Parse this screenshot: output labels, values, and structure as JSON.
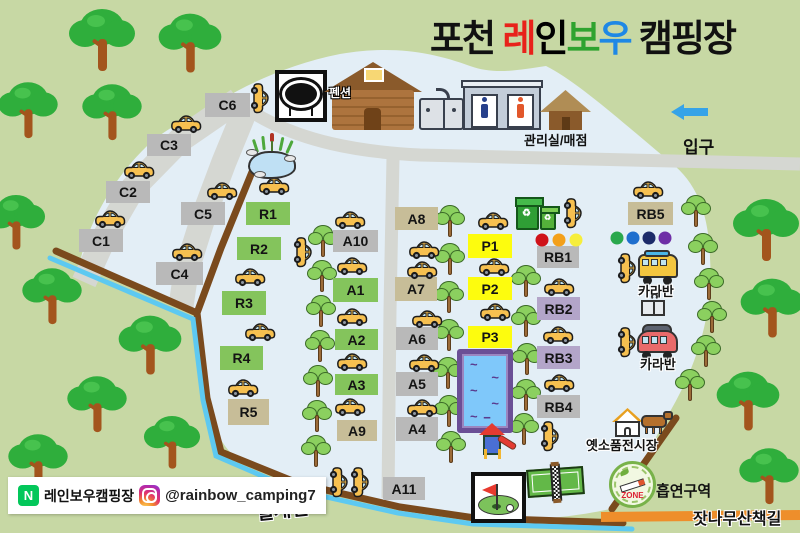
{
  "header": {
    "title_parts": [
      {
        "text": "포천 ",
        "color": "#111111"
      },
      {
        "text": "레",
        "color": "#e8221a"
      },
      {
        "text": "인",
        "color": "#f5b javascript81c"
      },
      {
        "text": "보",
        "color": "#2fa32f"
      },
      {
        "text": "우",
        "color": "#1e88e5"
      },
      {
        "text": " 캠핑장",
        "color": "#111111"
      }
    ]
  },
  "site_colors": {
    "gray": "#b9b9b9",
    "green": "#84c45c",
    "tan": "#c7bd98",
    "yellow": "#fdfc0e",
    "purple": "#b3a5c9"
  },
  "sites": [
    {
      "id": "C1",
      "label": "C1",
      "x": 79,
      "y": 229,
      "w": 44,
      "h": 23,
      "c": "gray"
    },
    {
      "id": "C2",
      "label": "C2",
      "x": 106,
      "y": 181,
      "w": 44,
      "h": 22,
      "c": "gray"
    },
    {
      "id": "C3",
      "label": "C3",
      "x": 147,
      "y": 134,
      "w": 44,
      "h": 22,
      "c": "gray"
    },
    {
      "id": "C4",
      "label": "C4",
      "x": 156,
      "y": 262,
      "w": 47,
      "h": 23,
      "c": "gray"
    },
    {
      "id": "C5",
      "label": "C5",
      "x": 181,
      "y": 202,
      "w": 44,
      "h": 23,
      "c": "gray"
    },
    {
      "id": "C6",
      "label": "C6",
      "x": 205,
      "y": 93,
      "w": 45,
      "h": 24,
      "c": "gray"
    },
    {
      "id": "R1",
      "label": "R1",
      "x": 246,
      "y": 202,
      "w": 44,
      "h": 23,
      "c": "green"
    },
    {
      "id": "R2",
      "label": "R2",
      "x": 237,
      "y": 237,
      "w": 44,
      "h": 23,
      "c": "green"
    },
    {
      "id": "R3",
      "label": "R3",
      "x": 222,
      "y": 291,
      "w": 44,
      "h": 24,
      "c": "green"
    },
    {
      "id": "R4",
      "label": "R4",
      "x": 220,
      "y": 346,
      "w": 43,
      "h": 24,
      "c": "green"
    },
    {
      "id": "R5",
      "label": "R5",
      "x": 228,
      "y": 399,
      "w": 41,
      "h": 26,
      "c": "tan"
    },
    {
      "id": "A1",
      "label": "A1",
      "x": 333,
      "y": 278,
      "w": 45,
      "h": 24,
      "c": "green"
    },
    {
      "id": "A2",
      "label": "A2",
      "x": 335,
      "y": 329,
      "w": 43,
      "h": 21,
      "c": "green"
    },
    {
      "id": "A3",
      "label": "A3",
      "x": 335,
      "y": 374,
      "w": 43,
      "h": 21,
      "c": "green"
    },
    {
      "id": "A4",
      "label": "A4",
      "x": 396,
      "y": 417,
      "w": 42,
      "h": 24,
      "c": "gray"
    },
    {
      "id": "A5",
      "label": "A5",
      "x": 396,
      "y": 372,
      "w": 42,
      "h": 24,
      "c": "gray"
    },
    {
      "id": "A6",
      "label": "A6",
      "x": 396,
      "y": 327,
      "w": 42,
      "h": 23,
      "c": "gray"
    },
    {
      "id": "A7",
      "label": "A7",
      "x": 395,
      "y": 277,
      "w": 42,
      "h": 24,
      "c": "tan"
    },
    {
      "id": "A8",
      "label": "A8",
      "x": 395,
      "y": 207,
      "w": 43,
      "h": 23,
      "c": "tan"
    },
    {
      "id": "A9",
      "label": "A9",
      "x": 337,
      "y": 420,
      "w": 40,
      "h": 21,
      "c": "tan"
    },
    {
      "id": "A10",
      "label": "A10",
      "x": 333,
      "y": 230,
      "w": 45,
      "h": 22,
      "c": "gray"
    },
    {
      "id": "A11",
      "label": "A11",
      "x": 383,
      "y": 477,
      "w": 42,
      "h": 23,
      "c": "gray"
    },
    {
      "id": "P1",
      "label": "P1",
      "x": 468,
      "y": 234,
      "w": 44,
      "h": 24,
      "c": "yellow"
    },
    {
      "id": "P2",
      "label": "P2",
      "x": 468,
      "y": 277,
      "w": 44,
      "h": 23,
      "c": "yellow"
    },
    {
      "id": "P3",
      "label": "P3",
      "x": 468,
      "y": 326,
      "w": 44,
      "h": 22,
      "c": "yellow"
    },
    {
      "id": "RB1",
      "label": "RB1",
      "x": 537,
      "y": 246,
      "w": 42,
      "h": 22,
      "c": "gray"
    },
    {
      "id": "RB2",
      "label": "RB2",
      "x": 537,
      "y": 297,
      "w": 43,
      "h": 23,
      "c": "purple"
    },
    {
      "id": "RB3",
      "label": "RB3",
      "x": 537,
      "y": 346,
      "w": 43,
      "h": 23,
      "c": "purple"
    },
    {
      "id": "RB4",
      "label": "RB4",
      "x": 537,
      "y": 395,
      "w": 43,
      "h": 23,
      "c": "gray"
    },
    {
      "id": "RB5",
      "label": "RB5",
      "x": 628,
      "y": 202,
      "w": 45,
      "h": 23,
      "c": "tan"
    }
  ],
  "rainbow_dots": [
    {
      "x": 542,
      "y": 240,
      "color": "#cf1219"
    },
    {
      "x": 559,
      "y": 240,
      "color": "#f3a01b"
    },
    {
      "x": 576,
      "y": 240,
      "color": "#f6ee3c"
    },
    {
      "x": 617,
      "y": 238,
      "color": "#2aa84d"
    },
    {
      "x": 633,
      "y": 238,
      "color": "#1f6fce"
    },
    {
      "x": 649,
      "y": 238,
      "color": "#1d2b69"
    },
    {
      "x": 665,
      "y": 238,
      "color": "#6e2ea6"
    }
  ],
  "map_labels": {
    "entrance": "입구",
    "office": "관리실/매점",
    "pension": "펜션",
    "caravan1": "카라반",
    "caravan2": "카라반",
    "exhibition": "옛소품전시장",
    "smoking_zone": "흡연구역",
    "smoking_badge": "ZONE",
    "pine_trail": "잣나무산책길",
    "stream": "실개천"
  },
  "footer": {
    "naver_icon": "N",
    "naver_label": "레인보우캠핑장",
    "instagram_handle": "@rainbow_camping7"
  },
  "recycle_symbol": "♻",
  "trees_large": [
    [
      102,
      42,
      1
    ],
    [
      190,
      45,
      0.95
    ],
    [
      28,
      112,
      0.9
    ],
    [
      112,
      114,
      0.9
    ],
    [
      16,
      224,
      0.88
    ],
    [
      52,
      298,
      0.9
    ],
    [
      150,
      347,
      0.95
    ],
    [
      97,
      406,
      0.9
    ],
    [
      172,
      444,
      0.85
    ],
    [
      38,
      464,
      0.9
    ],
    [
      766,
      232,
      1
    ],
    [
      772,
      310,
      0.95
    ],
    [
      748,
      403,
      0.95
    ],
    [
      769,
      478,
      0.9
    ]
  ],
  "trees_small": [
    [
      323,
      242
    ],
    [
      322,
      277
    ],
    [
      321,
      312
    ],
    [
      320,
      347
    ],
    [
      318,
      382
    ],
    [
      317,
      417
    ],
    [
      316,
      452
    ],
    [
      450,
      222
    ],
    [
      450,
      260
    ],
    [
      449,
      298
    ],
    [
      449,
      336
    ],
    [
      448,
      374
    ],
    [
      449,
      412
    ],
    [
      451,
      448
    ],
    [
      526,
      282
    ],
    [
      526,
      322
    ],
    [
      527,
      360
    ],
    [
      526,
      396
    ],
    [
      524,
      430
    ],
    [
      696,
      212
    ],
    [
      703,
      250
    ],
    [
      709,
      285
    ],
    [
      712,
      318
    ],
    [
      706,
      352
    ],
    [
      690,
      386
    ]
  ],
  "cars": [
    {
      "x": 186,
      "y": 124,
      "o": "h"
    },
    {
      "x": 139,
      "y": 170,
      "o": "h"
    },
    {
      "x": 110,
      "y": 219,
      "o": "h"
    },
    {
      "x": 222,
      "y": 191,
      "o": "h"
    },
    {
      "x": 187,
      "y": 252,
      "o": "h"
    },
    {
      "x": 274,
      "y": 186,
      "o": "h"
    },
    {
      "x": 250,
      "y": 277,
      "o": "h"
    },
    {
      "x": 260,
      "y": 332,
      "o": "h"
    },
    {
      "x": 243,
      "y": 388,
      "o": "h"
    },
    {
      "x": 350,
      "y": 220,
      "o": "h"
    },
    {
      "x": 352,
      "y": 266,
      "o": "h"
    },
    {
      "x": 352,
      "y": 317,
      "o": "h"
    },
    {
      "x": 352,
      "y": 362,
      "o": "h"
    },
    {
      "x": 350,
      "y": 407,
      "o": "h"
    },
    {
      "x": 424,
      "y": 250,
      "o": "h"
    },
    {
      "x": 422,
      "y": 270,
      "o": "h"
    },
    {
      "x": 427,
      "y": 319,
      "o": "h"
    },
    {
      "x": 424,
      "y": 363,
      "o": "h"
    },
    {
      "x": 422,
      "y": 408,
      "o": "h"
    },
    {
      "x": 493,
      "y": 221,
      "o": "h"
    },
    {
      "x": 494,
      "y": 267,
      "o": "h"
    },
    {
      "x": 495,
      "y": 312,
      "o": "h"
    },
    {
      "x": 559,
      "y": 287,
      "o": "h"
    },
    {
      "x": 558,
      "y": 335,
      "o": "h"
    },
    {
      "x": 559,
      "y": 383,
      "o": "h"
    },
    {
      "x": 648,
      "y": 190,
      "o": "h"
    },
    {
      "x": 260,
      "y": 98,
      "o": "v"
    },
    {
      "x": 303,
      "y": 252,
      "o": "v"
    },
    {
      "x": 573,
      "y": 213,
      "o": "v"
    },
    {
      "x": 627,
      "y": 268,
      "o": "v"
    },
    {
      "x": 627,
      "y": 342,
      "o": "v"
    },
    {
      "x": 550,
      "y": 436,
      "o": "v"
    },
    {
      "x": 339,
      "y": 482,
      "o": "v"
    },
    {
      "x": 360,
      "y": 482,
      "o": "v"
    }
  ]
}
